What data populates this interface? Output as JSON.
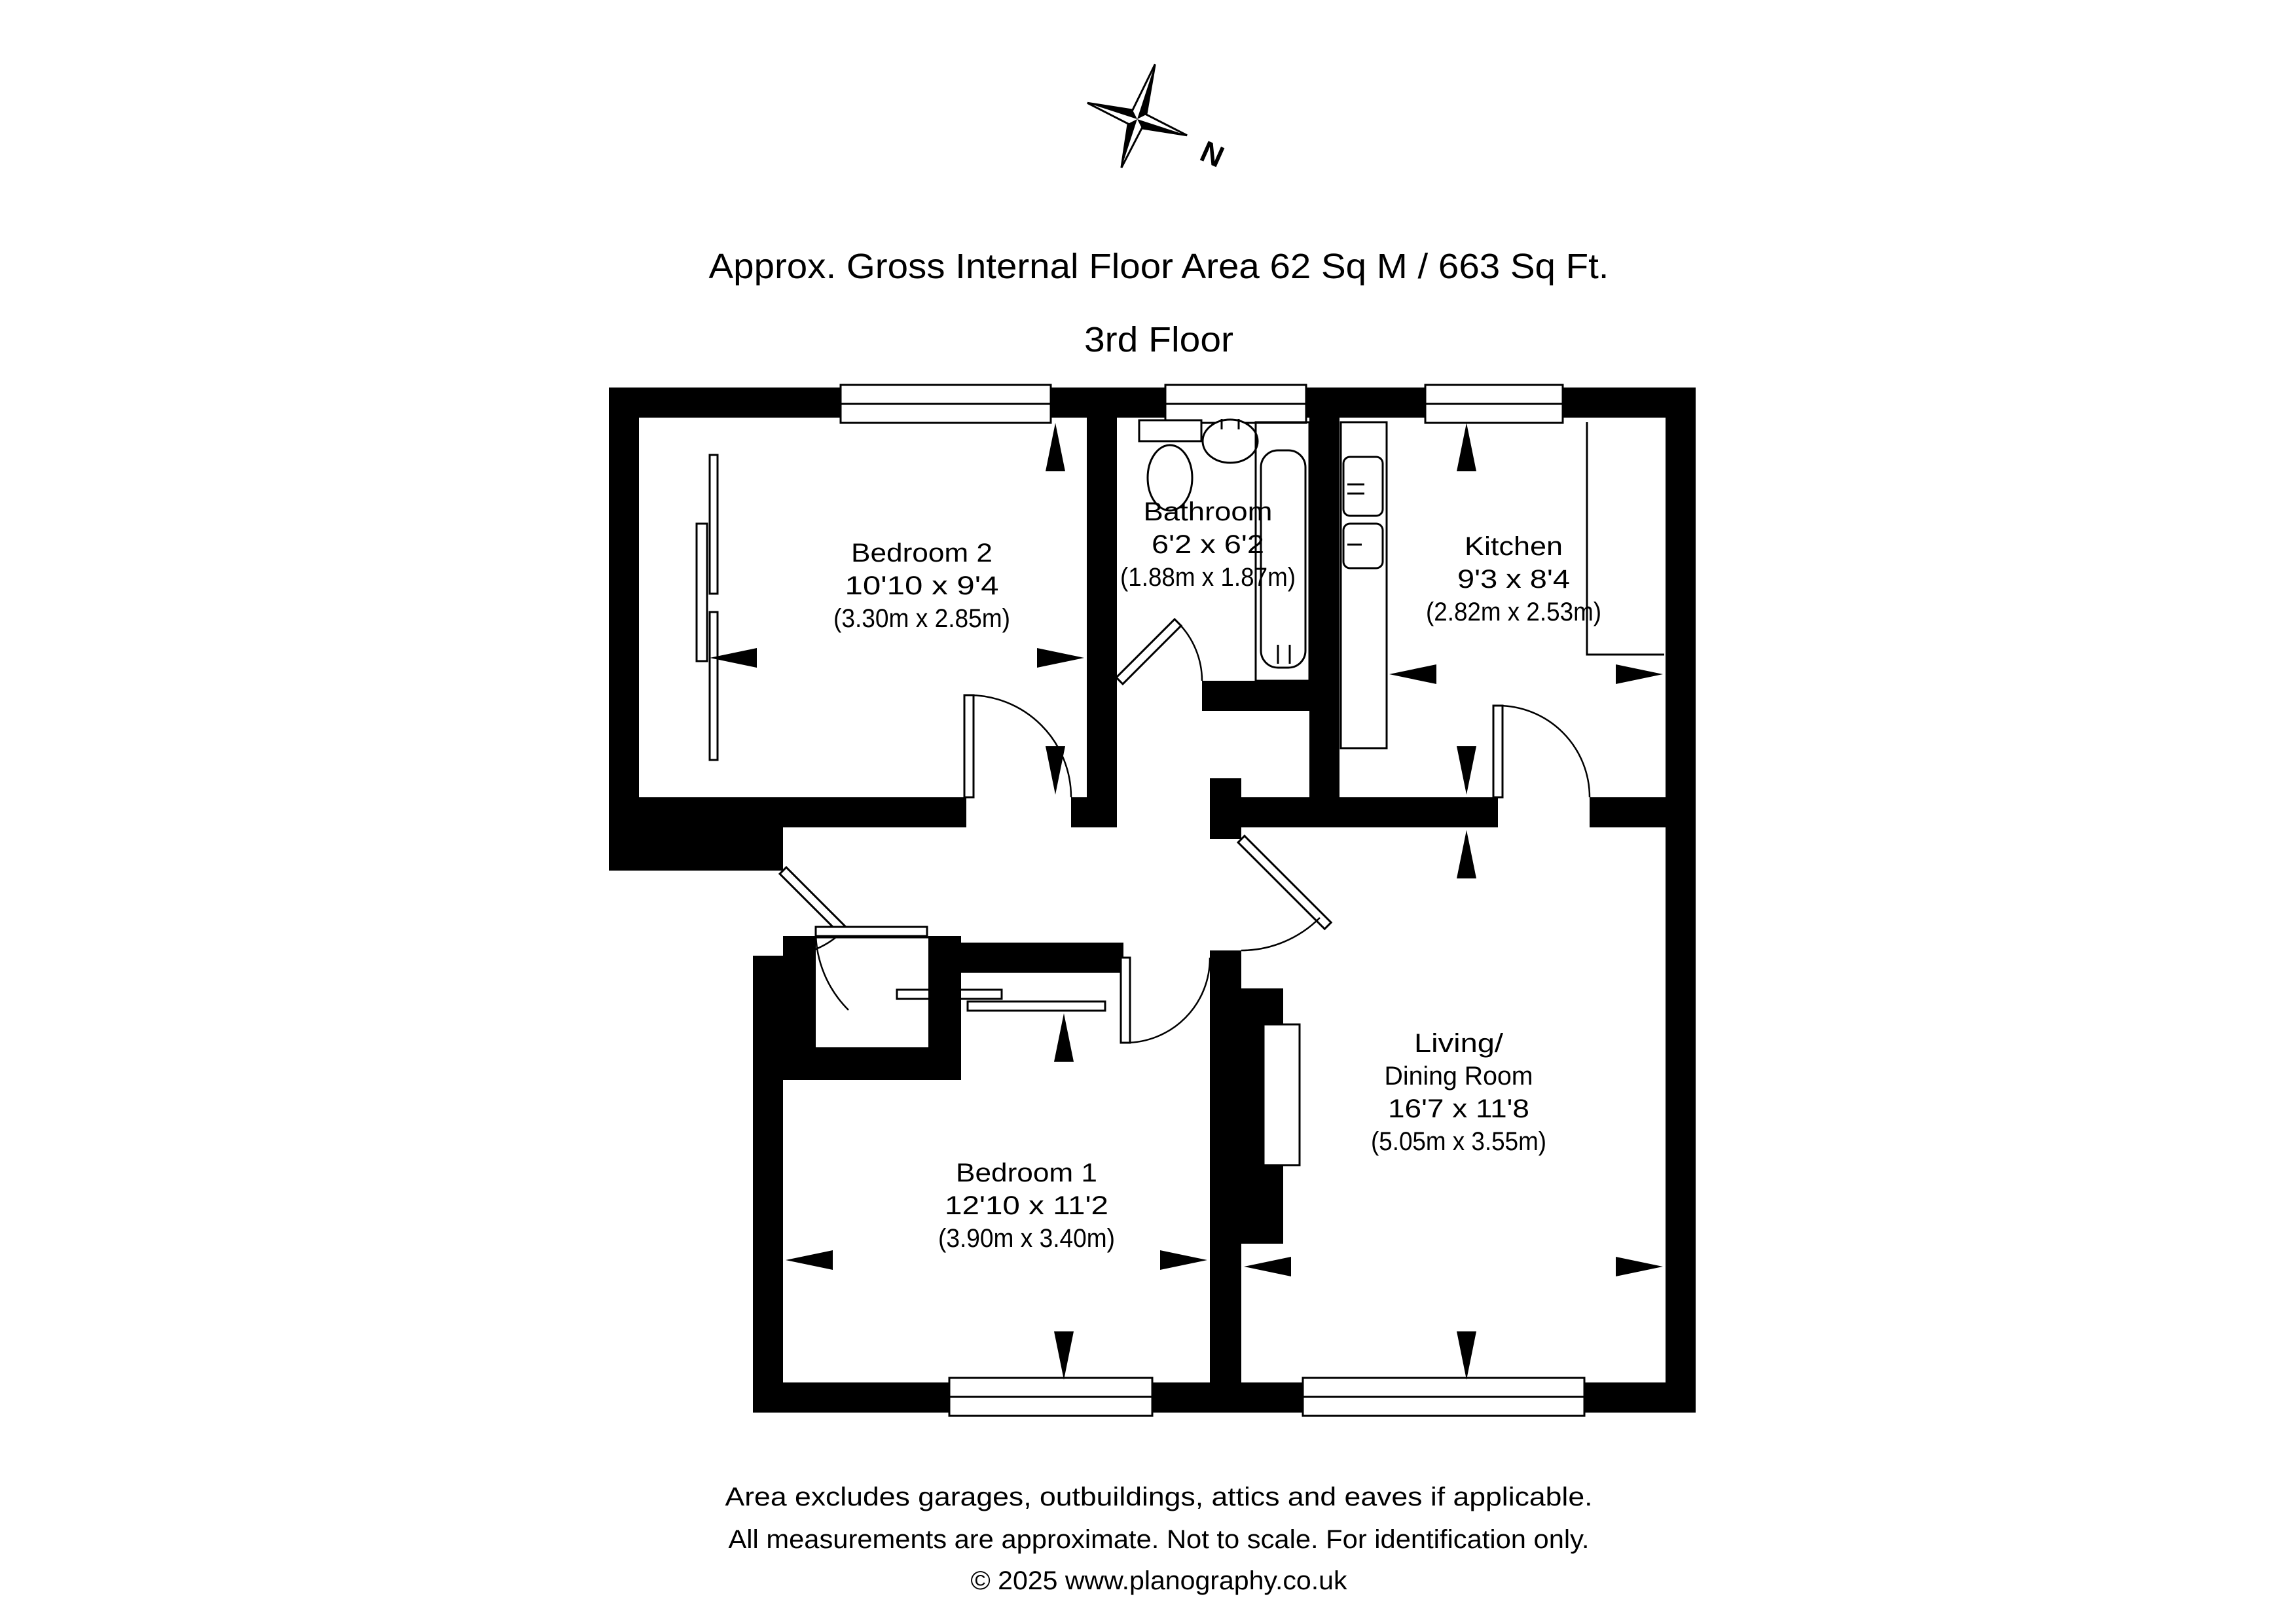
{
  "header": {
    "title": "Approx. Gross Internal Floor Area 62 Sq M / 663 Sq Ft.",
    "floor": "3rd Floor"
  },
  "compass": {
    "north_label": "N"
  },
  "rooms": {
    "bedroom2": {
      "name": "Bedroom 2",
      "dims_ft": "10'10 x 9'4",
      "dims_m": "(3.30m x 2.85m)"
    },
    "bathroom": {
      "name": "Bathroom",
      "dims_ft": "6'2 x 6'2",
      "dims_m": "(1.88m x 1.87m)"
    },
    "kitchen": {
      "name": "Kitchen",
      "dims_ft": "9'3 x 8'4",
      "dims_m": "(2.82m x 2.53m)"
    },
    "living": {
      "name_line1": "Living/",
      "name_line2": "Dining Room",
      "dims_ft": "16'7 x 11'8",
      "dims_m": "(5.05m x 3.55m)"
    },
    "bedroom1": {
      "name": "Bedroom 1",
      "dims_ft": "12'10 x 11'2",
      "dims_m": "(3.90m x 3.40m)"
    }
  },
  "footer": {
    "line1": "Area excludes garages, outbuildings, attics and eaves if applicable.",
    "line2": "All measurements are approximate. Not to scale. For identification only.",
    "line3": "© 2025 www.planography.co.uk"
  },
  "colors": {
    "ink": "#000000",
    "paper": "#ffffff"
  }
}
